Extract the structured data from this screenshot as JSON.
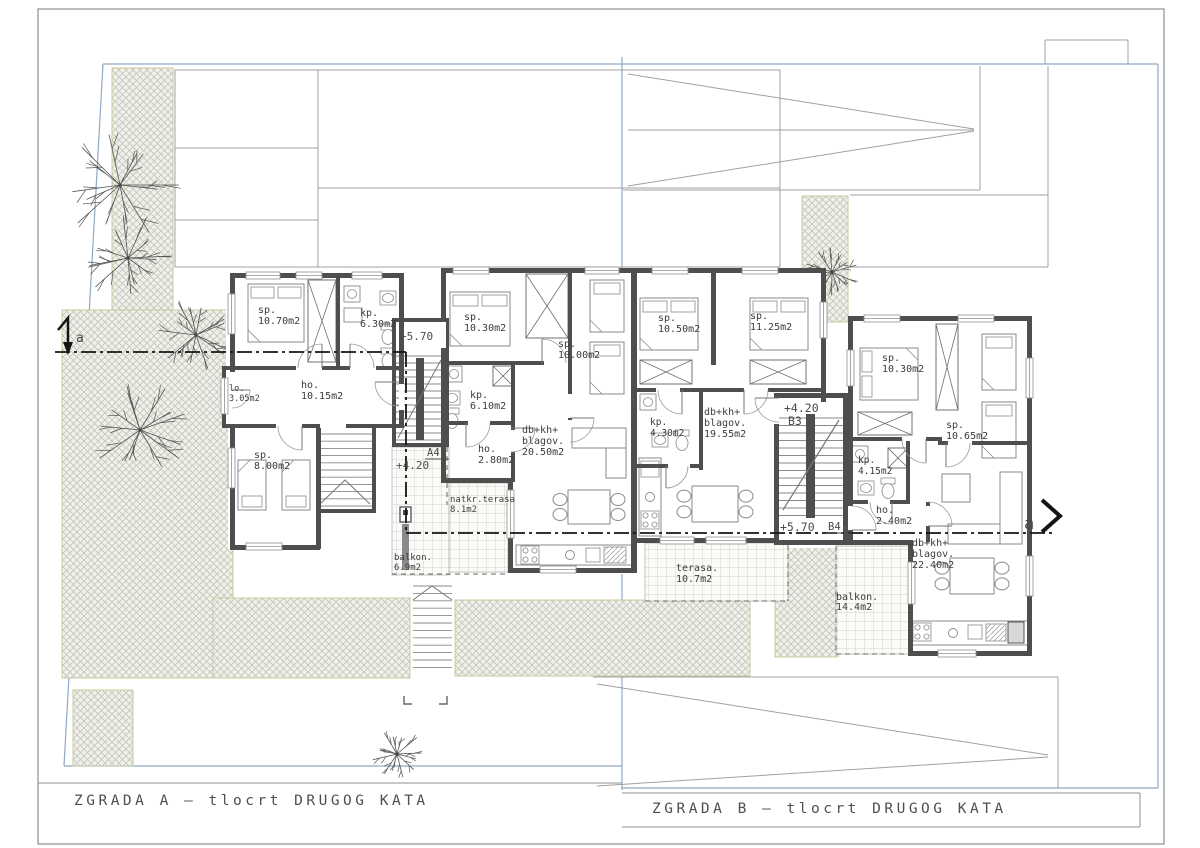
{
  "titles": {
    "zgrada_a": "ZGRADA A — tlocrt DRUGOG KATA",
    "zgrada_b": "ZGRADA B — tlocrt DRUGOG KATA"
  },
  "markers": {
    "left": "a",
    "right": "a"
  },
  "levels": {
    "a_stair": "+5.70",
    "a_ref": "A4'",
    "a_level": "+4.20",
    "b_upper": "+4.20",
    "b3": "B3",
    "b_lower": "+5.70",
    "b4": "B4'"
  },
  "rooms": {
    "a1": [
      {
        "name": "sp.",
        "area": "10.70m2"
      },
      {
        "name": "kp.",
        "area": "6.30m2"
      },
      {
        "name": "lo.",
        "area": "3.05m2"
      },
      {
        "name": "ho.",
        "area": "10.15m2"
      },
      {
        "name": "sp.",
        "area": "8.00m2"
      },
      {
        "name": "balkon.",
        "area": "6.9m2"
      },
      {
        "name": "natkr.terasa",
        "area": "8.1m2"
      }
    ],
    "a2": [
      {
        "name": "sp.",
        "area": "10.30m2"
      },
      {
        "name": "sp.",
        "area": "10.00m2"
      },
      {
        "name": "kp.",
        "area": "6.10m2"
      },
      {
        "name": "ho.",
        "area": "2.80m2"
      },
      {
        "line1": "db+kh+",
        "line2": "blagov.",
        "area": "20.50m2"
      }
    ],
    "b1": [
      {
        "name": "sp.",
        "area": "10.50m2"
      },
      {
        "name": "sp.",
        "area": "11.25m2"
      },
      {
        "name": "kp.",
        "area": "4.30m2"
      },
      {
        "line1": "db+kh+",
        "line2": "blagov.",
        "area": "19.55m2"
      },
      {
        "name": "terasa.",
        "area": "10.7m2"
      }
    ],
    "b2": [
      {
        "name": "sp.",
        "area": "10.30m2"
      },
      {
        "name": "sp.",
        "area": "10.65m2"
      },
      {
        "name": "kp.",
        "area": "4.15m2"
      },
      {
        "name": "ho.",
        "area": "2.40m2"
      },
      {
        "line1": "db+kh+",
        "line2": "blagov.",
        "area": "22.40m2"
      },
      {
        "name": "balkon.",
        "area": "14.4m2"
      }
    ]
  },
  "colors": {
    "wall": "#4e4e4e",
    "boundary_blue": "#8fa9c4",
    "site_line": "#a0a0a0",
    "hatch_edge": "#c6cc9c",
    "paper": "#ffffff",
    "text": "#3b3b3b"
  }
}
